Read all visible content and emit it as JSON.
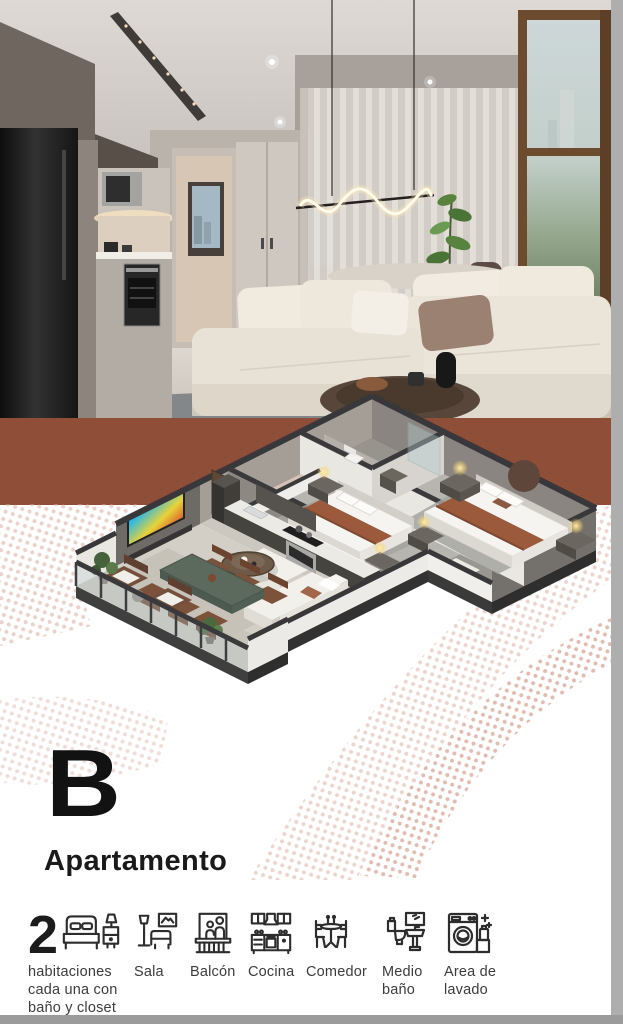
{
  "plan": {
    "letter": "B",
    "title": "Apartamento"
  },
  "features": {
    "items": [
      {
        "icon": "bed-icon",
        "count": "2",
        "label": "habitaciones cada una con baño y closet"
      },
      {
        "icon": "sofa-lamp-icon",
        "label": "Sala"
      },
      {
        "icon": "balcony-icon",
        "label": "Balcón"
      },
      {
        "icon": "kitchen-icon",
        "label": "Cocina"
      },
      {
        "icon": "dining-icon",
        "label": "Comedor"
      },
      {
        "icon": "toilet-sink-icon",
        "label": "Medio baño"
      },
      {
        "icon": "washer-icon",
        "label": "Area de lavado"
      }
    ]
  },
  "colors": {
    "band": "#8e4e37",
    "halftone_dot": "#d9ab9e",
    "letter": "#121212",
    "icon_stroke": "#2d2d2d",
    "page_edge": "#aeaeae",
    "bed_runner": "#9a5a3b",
    "floorplan_wall_cap": "#38383a"
  }
}
